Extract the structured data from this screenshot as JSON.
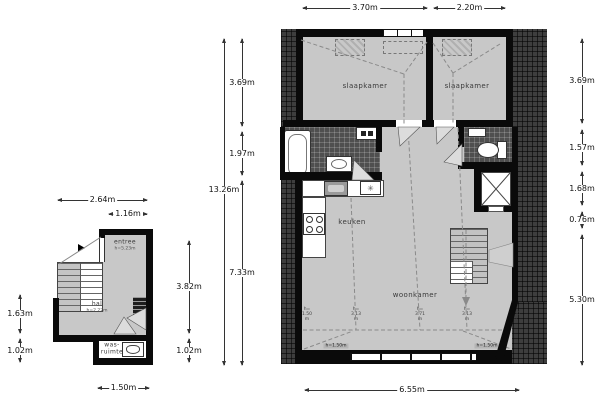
{
  "left_plan": {
    "dims": {
      "top1": "2.64m",
      "top2": "1.16m",
      "left1": "1.63m",
      "left2": "1.02m",
      "right1": "3.82m",
      "right2": "1.02m",
      "bottom": "1.50m"
    },
    "rooms": {
      "entree": {
        "name": "entree",
        "height": "h=5.23m"
      },
      "hal": {
        "name": "hal",
        "height": "h=2.22m"
      },
      "was": {
        "line1": "was-",
        "line2": "ruimte"
      }
    }
  },
  "mp": {
    "dims": {
      "top1": "3.70m",
      "top2": "2.20m",
      "left_total": "13.26m",
      "left1": "3.69m",
      "left2": "1.97m",
      "left3": "7.33m",
      "right1": "3.69m",
      "right2": "1.57m",
      "right3": "1.68m",
      "right4": "0.76m",
      "right5": "5.30m",
      "bottom": "6.55m"
    },
    "rooms": {
      "bed1": "slaapkamer",
      "bed2": "slaapkamer",
      "kitchen": "keuken",
      "living": "woonkamer"
    },
    "heights": {
      "prefix": "h=",
      "unit": "m",
      "v": [
        "1.50",
        "3.13",
        "3.71",
        "3.13",
        "1.50"
      ],
      "box": "h=1.50m"
    }
  },
  "icons": {
    "extractor": "✳"
  }
}
